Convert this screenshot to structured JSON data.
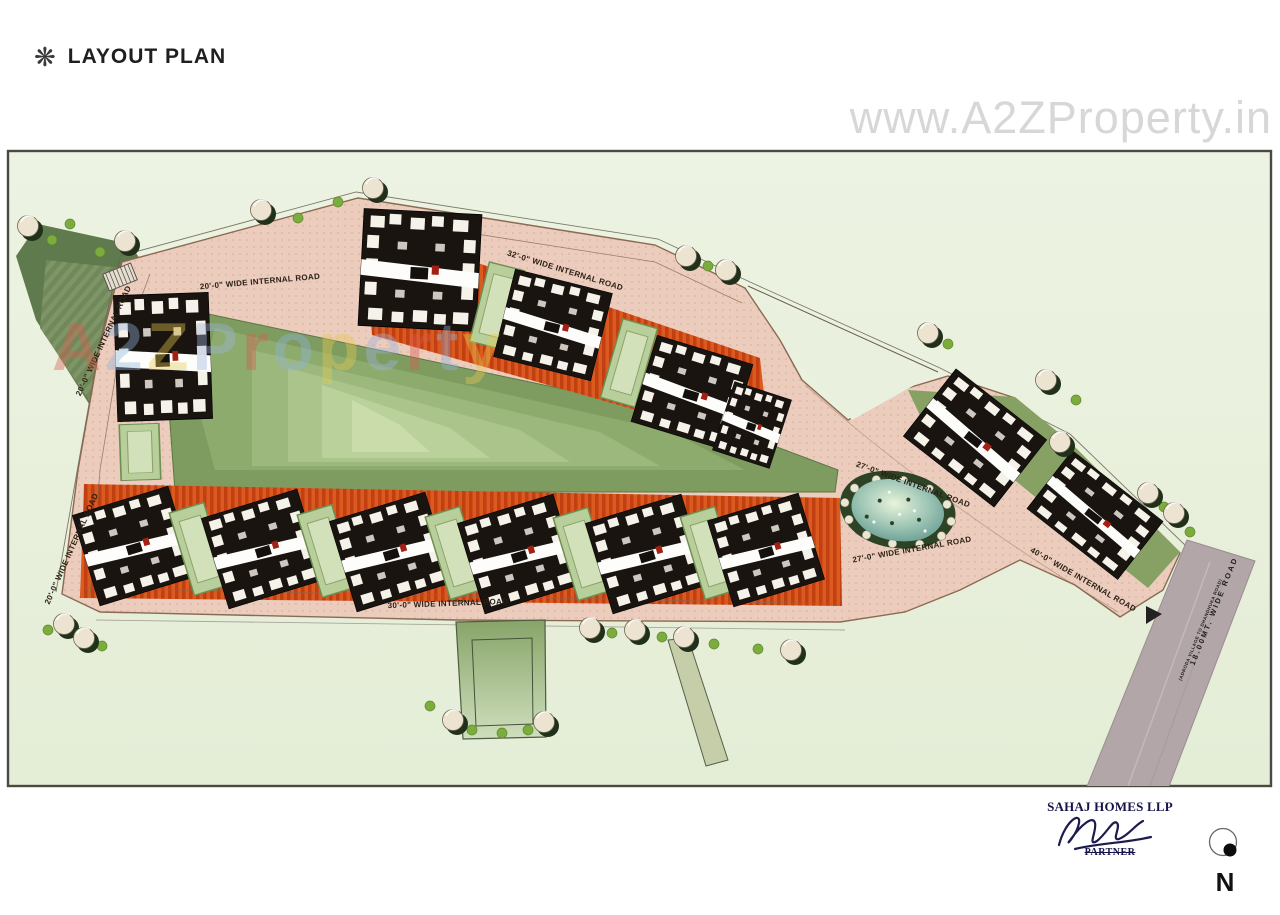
{
  "header": {
    "title": "LAYOUT PLAN",
    "ornament": "❋"
  },
  "watermarks": {
    "top": "www.A2ZProperty.in",
    "overlay": "A2ZProperty"
  },
  "plan": {
    "road_labels": [
      {
        "text": "20'-0\" WIDE INTERNAL ROAD"
      },
      {
        "text": "32'-0\" WIDE INTERNAL ROAD"
      },
      {
        "text": "20'-0\" WIDE INTERNAL ROAD"
      },
      {
        "text": "20'-0\" WIDE INTERNAL ROAD"
      },
      {
        "text": "30'-0\" WIDE INTERNAL ROAD"
      },
      {
        "text": "27'-0\" WIDE INTERNAL ROAD"
      },
      {
        "text": "27'-0\" WIDE INTERNAL ROAD"
      },
      {
        "text": "40'-0\" WIDE INTERNAL ROAD"
      },
      {
        "text": "18.00MT. WIDE ROAD"
      },
      {
        "text": "(ADRODA VILLAGE TO DHANDHUKA ROAD)"
      }
    ],
    "colors": {
      "paper": "#ffffff",
      "plan_background": "#e9f0de",
      "site_road": "#ebccbd",
      "plot_strip": "#da5a20",
      "lawn": "#b9cf9b",
      "building": "#191410",
      "pond_water": "#9cc4b4",
      "highway": "#b3a6a9",
      "watermark_grey": "#d7d7d7"
    }
  },
  "signature": {
    "company": "SAHAJ HOMES LLP",
    "role": "PARTNER"
  },
  "compass": {
    "label": "N"
  }
}
